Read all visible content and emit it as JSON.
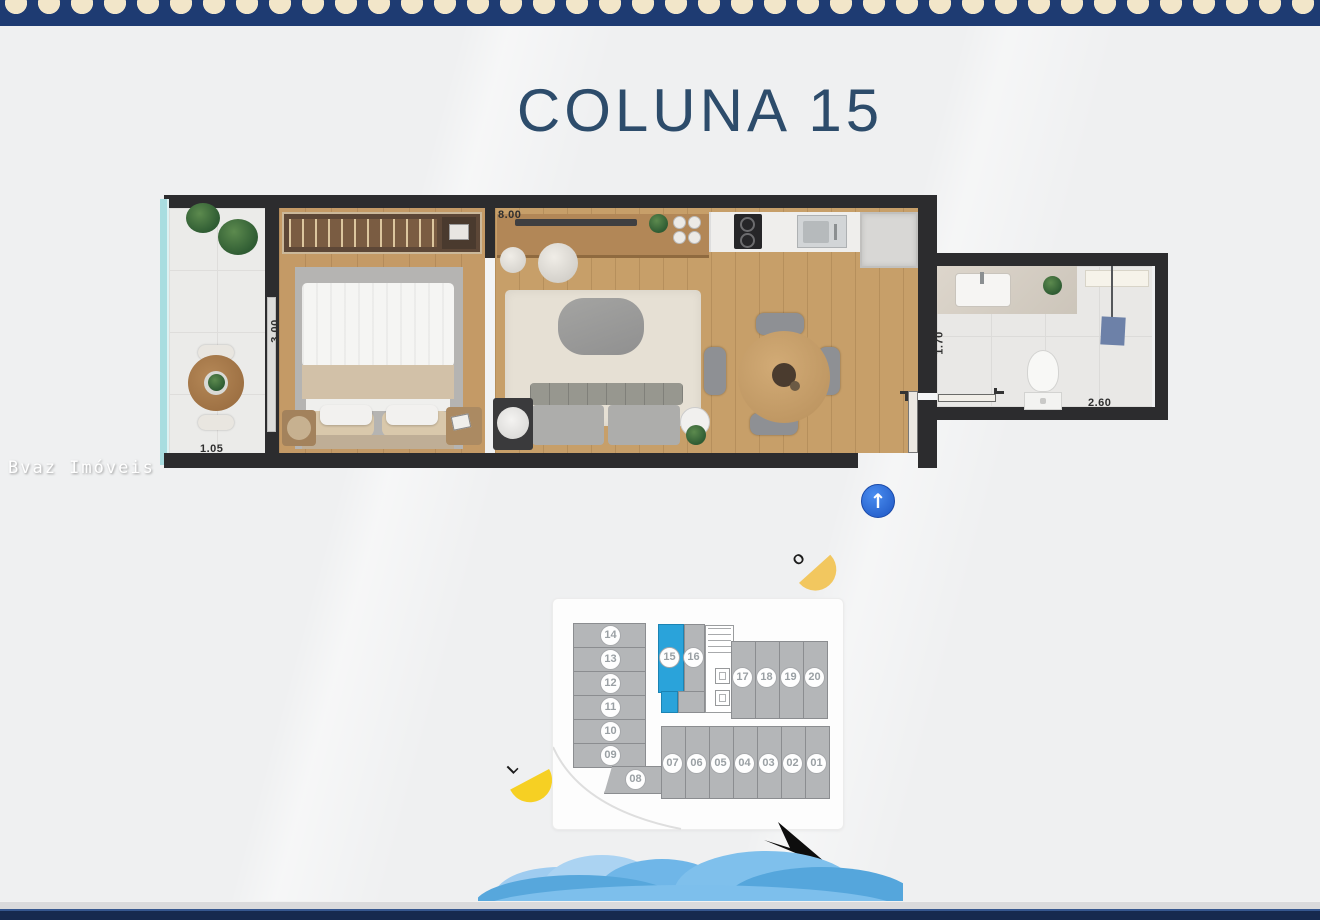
{
  "page": {
    "title": "COLUNA 15",
    "watermark": "Bvaz Imóveis"
  },
  "plan": {
    "dimensions": {
      "living_length": "8.00",
      "bedroom_width": "3.00",
      "balcony_depth": "1.05",
      "bath_hall_width": "1.70",
      "bathroom_length": "2.60"
    },
    "entrance_arrow": "↑"
  },
  "compass": {
    "west": "O",
    "east": "L",
    "north": "N"
  },
  "key_plan": {
    "highlighted_unit": "15",
    "units": [
      "14",
      "13",
      "12",
      "11",
      "10",
      "09",
      "08",
      "15",
      "16",
      "17",
      "18",
      "19",
      "20",
      "07",
      "06",
      "05",
      "04",
      "03",
      "02",
      "01"
    ]
  },
  "colors": {
    "navy_border": "#1e3b72",
    "shell_cream": "#f2e6c9",
    "title_blue": "#2d4c6b",
    "highlight_blue": "#2aa3da",
    "sun_yellow": "#f6d023",
    "sun_gold": "#f2c75f",
    "wave_blue": "#7abdea",
    "arrow_blue": "#2563c9"
  }
}
